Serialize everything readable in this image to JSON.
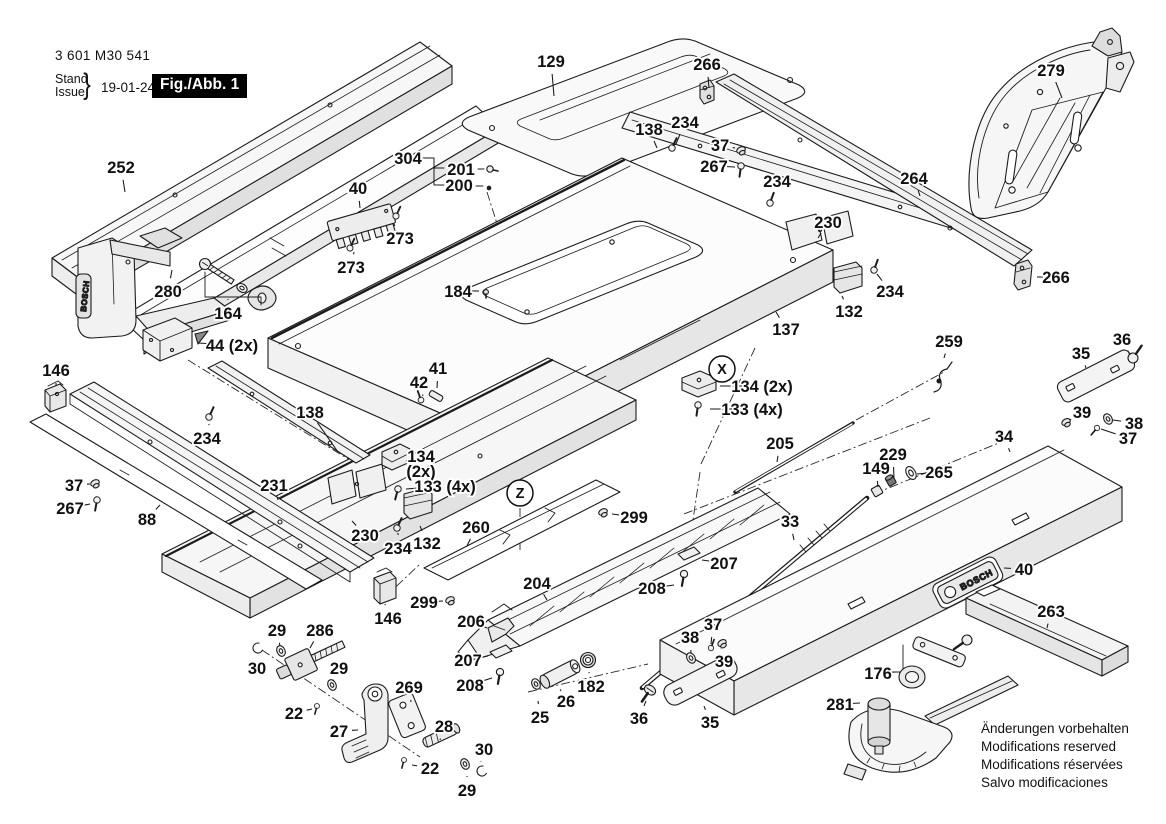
{
  "header": {
    "part_number": "3 601 M30 541",
    "stand_label": "Stand",
    "issue_label": "Issue",
    "brace": "}",
    "date": "19-01-24",
    "figure_label": "Fig./Abb. 1"
  },
  "notes": [
    "Änderungen vorbehalten",
    "Modifications reserved",
    "Modifications réservées",
    "Salvo modificaciones"
  ],
  "brand": "BOSCH",
  "colors": {
    "ink": "#1b1b1b",
    "fig_box_bg": "#000000",
    "fig_box_text": "#ffffff",
    "paper": "#ffffff"
  },
  "markers": [
    {
      "t": "X",
      "x": 722,
      "y": 369
    },
    {
      "t": "Z",
      "x": 520,
      "y": 493
    }
  ],
  "callouts": [
    {
      "t": "252",
      "x": 121,
      "y": 167,
      "lead": [
        125,
        192
      ]
    },
    {
      "t": "129",
      "x": 551,
      "y": 61,
      "lead": [
        554,
        96
      ]
    },
    {
      "t": "266",
      "x": 707,
      "y": 64,
      "lead": [
        709,
        88
      ]
    },
    {
      "t": "279",
      "x": 1051,
      "y": 70,
      "lead": [
        1062,
        98
      ]
    },
    {
      "t": "304",
      "x": 408,
      "y": 158
    },
    {
      "t": "201",
      "x": 461,
      "y": 169
    },
    {
      "t": "200",
      "x": 459,
      "y": 185
    },
    {
      "t": "40",
      "x": 358,
      "y": 188,
      "lead": [
        360,
        208
      ]
    },
    {
      "t": "273",
      "x": 400,
      "y": 238,
      "lead": [
        394,
        224
      ]
    },
    {
      "t": "273",
      "x": 351,
      "y": 267,
      "lead": [
        354,
        252
      ]
    },
    {
      "t": "138",
      "x": 649,
      "y": 129,
      "lead": [
        657,
        148
      ]
    },
    {
      "t": "234",
      "x": 685,
      "y": 122,
      "lead": [
        676,
        144
      ]
    },
    {
      "t": "37",
      "x": 720,
      "y": 145,
      "lead": [
        735,
        148
      ]
    },
    {
      "t": "267",
      "x": 714,
      "y": 166,
      "lead": [
        735,
        167
      ]
    },
    {
      "t": "234",
      "x": 777,
      "y": 181,
      "lead": [
        772,
        198
      ]
    },
    {
      "t": "264",
      "x": 914,
      "y": 178,
      "lead": [
        920,
        196
      ]
    },
    {
      "t": "230",
      "x": 828,
      "y": 222,
      "lead": [
        818,
        238
      ]
    },
    {
      "t": "266",
      "x": 1056,
      "y": 277,
      "lead": [
        1037,
        277
      ]
    },
    {
      "t": "234",
      "x": 890,
      "y": 291,
      "lead": [
        877,
        274
      ]
    },
    {
      "t": "132",
      "x": 849,
      "y": 311,
      "lead": [
        842,
        296
      ]
    },
    {
      "t": "137",
      "x": 786,
      "y": 329,
      "lead": [
        776,
        312
      ]
    },
    {
      "t": "184",
      "x": 458,
      "y": 291,
      "lead": [
        479,
        291
      ]
    },
    {
      "t": "280",
      "x": 168,
      "y": 291,
      "lead": [
        172,
        270
      ]
    },
    {
      "t": "164",
      "x": 228,
      "y": 313,
      "lead": [
        228,
        299
      ]
    },
    {
      "t": "44 (2x)",
      "x": 232,
      "y": 345,
      "lead": [
        198,
        343
      ]
    },
    {
      "t": "146",
      "x": 56,
      "y": 370,
      "lead": [
        56,
        386
      ]
    },
    {
      "t": "36",
      "x": 1122,
      "y": 339,
      "lead": [
        1130,
        355
      ]
    },
    {
      "t": "35",
      "x": 1081,
      "y": 353,
      "lead": [
        1086,
        368
      ]
    },
    {
      "t": "259",
      "x": 949,
      "y": 341,
      "lead": [
        944,
        358
      ]
    },
    {
      "t": "134 (2x)",
      "x": 762,
      "y": 386,
      "lead": [
        720,
        386
      ]
    },
    {
      "t": "133 (4x)",
      "x": 752,
      "y": 409,
      "lead": [
        710,
        409
      ]
    },
    {
      "t": "41",
      "x": 438,
      "y": 368,
      "lead": [
        437,
        388
      ]
    },
    {
      "t": "42",
      "x": 419,
      "y": 382,
      "lead": [
        423,
        396
      ]
    },
    {
      "t": "39",
      "x": 1082,
      "y": 412,
      "lead": [
        1070,
        420
      ]
    },
    {
      "t": "38",
      "x": 1134,
      "y": 423,
      "lead": [
        1113,
        420
      ]
    },
    {
      "t": "37",
      "x": 1128,
      "y": 438,
      "lead": [
        1101,
        429
      ]
    },
    {
      "t": "34",
      "x": 1004,
      "y": 436,
      "lead": [
        1010,
        452
      ]
    },
    {
      "t": "138",
      "x": 310,
      "y": 412,
      "lead": [
        338,
        452
      ]
    },
    {
      "t": "234",
      "x": 207,
      "y": 438,
      "lead": [
        209,
        424
      ]
    },
    {
      "t": "205",
      "x": 780,
      "y": 443,
      "lead": [
        777,
        462
      ]
    },
    {
      "t": "229",
      "x": 893,
      "y": 454,
      "lead": [
        894,
        478
      ]
    },
    {
      "t": "149",
      "x": 876,
      "y": 468,
      "lead": [
        878,
        487
      ]
    },
    {
      "t": "265",
      "x": 939,
      "y": 472,
      "lead": [
        917,
        474
      ]
    },
    {
      "t": "231",
      "x": 274,
      "y": 485,
      "lead": [
        278,
        500
      ]
    },
    {
      "t": "37",
      "x": 74,
      "y": 485,
      "lead": [
        90,
        484
      ]
    },
    {
      "t": "267",
      "x": 70,
      "y": 508,
      "lead": [
        90,
        504
      ]
    },
    {
      "t": "88",
      "x": 147,
      "y": 519,
      "lead": [
        160,
        505
      ]
    },
    {
      "t": "33",
      "x": 790,
      "y": 521,
      "lead": [
        794,
        540
      ]
    },
    {
      "t": "230",
      "x": 365,
      "y": 535,
      "lead": [
        352,
        521
      ]
    },
    {
      "t": "234",
      "x": 398,
      "y": 548,
      "lead": [
        398,
        533
      ]
    },
    {
      "t": "132",
      "x": 427,
      "y": 543,
      "lead": [
        420,
        526
      ]
    },
    {
      "t": "260",
      "x": 476,
      "y": 527,
      "lead": [
        467,
        546
      ]
    },
    {
      "t": "134",
      "t2": "(2x)",
      "x": 421,
      "y": 456,
      "lead": [
        406,
        461
      ]
    },
    {
      "t": "133 (4x)",
      "x": 445,
      "y": 486,
      "lead": [
        406,
        489
      ]
    },
    {
      "t": "299",
      "x": 424,
      "y": 602,
      "lead": [
        443,
        601
      ]
    },
    {
      "t": "299",
      "x": 634,
      "y": 517,
      "lead": [
        612,
        514
      ]
    },
    {
      "t": "204",
      "x": 537,
      "y": 583,
      "lead": [
        547,
        600
      ]
    },
    {
      "t": "208",
      "x": 652,
      "y": 588,
      "lead": [
        674,
        585
      ]
    },
    {
      "t": "207",
      "x": 724,
      "y": 563,
      "lead": [
        702,
        560
      ]
    },
    {
      "t": "206",
      "x": 471,
      "y": 621,
      "lead": [
        487,
        628
      ]
    },
    {
      "t": "207",
      "x": 468,
      "y": 660,
      "lead": [
        488,
        656
      ]
    },
    {
      "t": "208",
      "x": 470,
      "y": 685,
      "lead": [
        492,
        678
      ]
    },
    {
      "t": "146",
      "x": 388,
      "y": 618,
      "lead": [
        385,
        604
      ]
    },
    {
      "t": "29",
      "x": 277,
      "y": 630,
      "lead": [
        280,
        646
      ]
    },
    {
      "t": "30",
      "x": 257,
      "y": 668,
      "lead": [
        259,
        655
      ]
    },
    {
      "t": "286",
      "x": 320,
      "y": 630,
      "lead": [
        310,
        648
      ]
    },
    {
      "t": "29",
      "x": 339,
      "y": 668,
      "lead": [
        333,
        681
      ]
    },
    {
      "t": "22",
      "x": 294,
      "y": 713,
      "lead": [
        312,
        709
      ]
    },
    {
      "t": "27",
      "x": 339,
      "y": 731,
      "lead": [
        358,
        730
      ]
    },
    {
      "t": "269",
      "x": 409,
      "y": 687,
      "lead": [
        411,
        702
      ]
    },
    {
      "t": "28",
      "x": 444,
      "y": 726,
      "lead": [
        440,
        740
      ]
    },
    {
      "t": "30",
      "x": 484,
      "y": 749,
      "lead": [
        481,
        761
      ]
    },
    {
      "t": "22",
      "x": 430,
      "y": 768,
      "lead": [
        412,
        765
      ]
    },
    {
      "t": "29",
      "x": 467,
      "y": 790,
      "lead": [
        467,
        776
      ]
    },
    {
      "t": "25",
      "x": 540,
      "y": 717,
      "lead": [
        538,
        701
      ]
    },
    {
      "t": "26",
      "x": 566,
      "y": 701,
      "lead": [
        561,
        691
      ]
    },
    {
      "t": "182",
      "x": 591,
      "y": 686,
      "lead": [
        589,
        672
      ]
    },
    {
      "t": "36",
      "x": 639,
      "y": 718,
      "lead": [
        646,
        701
      ]
    },
    {
      "t": "35",
      "x": 710,
      "y": 722,
      "lead": [
        704,
        706
      ]
    },
    {
      "t": "38",
      "x": 690,
      "y": 637,
      "lead": [
        691,
        653
      ]
    },
    {
      "t": "37",
      "x": 713,
      "y": 624,
      "lead": [
        711,
        644
      ]
    },
    {
      "t": "39",
      "x": 724,
      "y": 661,
      "lead": [
        721,
        648
      ]
    },
    {
      "t": "40",
      "x": 1024,
      "y": 569,
      "lead": [
        1004,
        568
      ]
    },
    {
      "t": "263",
      "x": 1051,
      "y": 611,
      "lead": [
        1047,
        628
      ]
    },
    {
      "t": "176",
      "x": 878,
      "y": 673,
      "lead": [
        896,
        672
      ]
    },
    {
      "t": "281",
      "x": 840,
      "y": 704,
      "lead": [
        860,
        703
      ]
    }
  ]
}
